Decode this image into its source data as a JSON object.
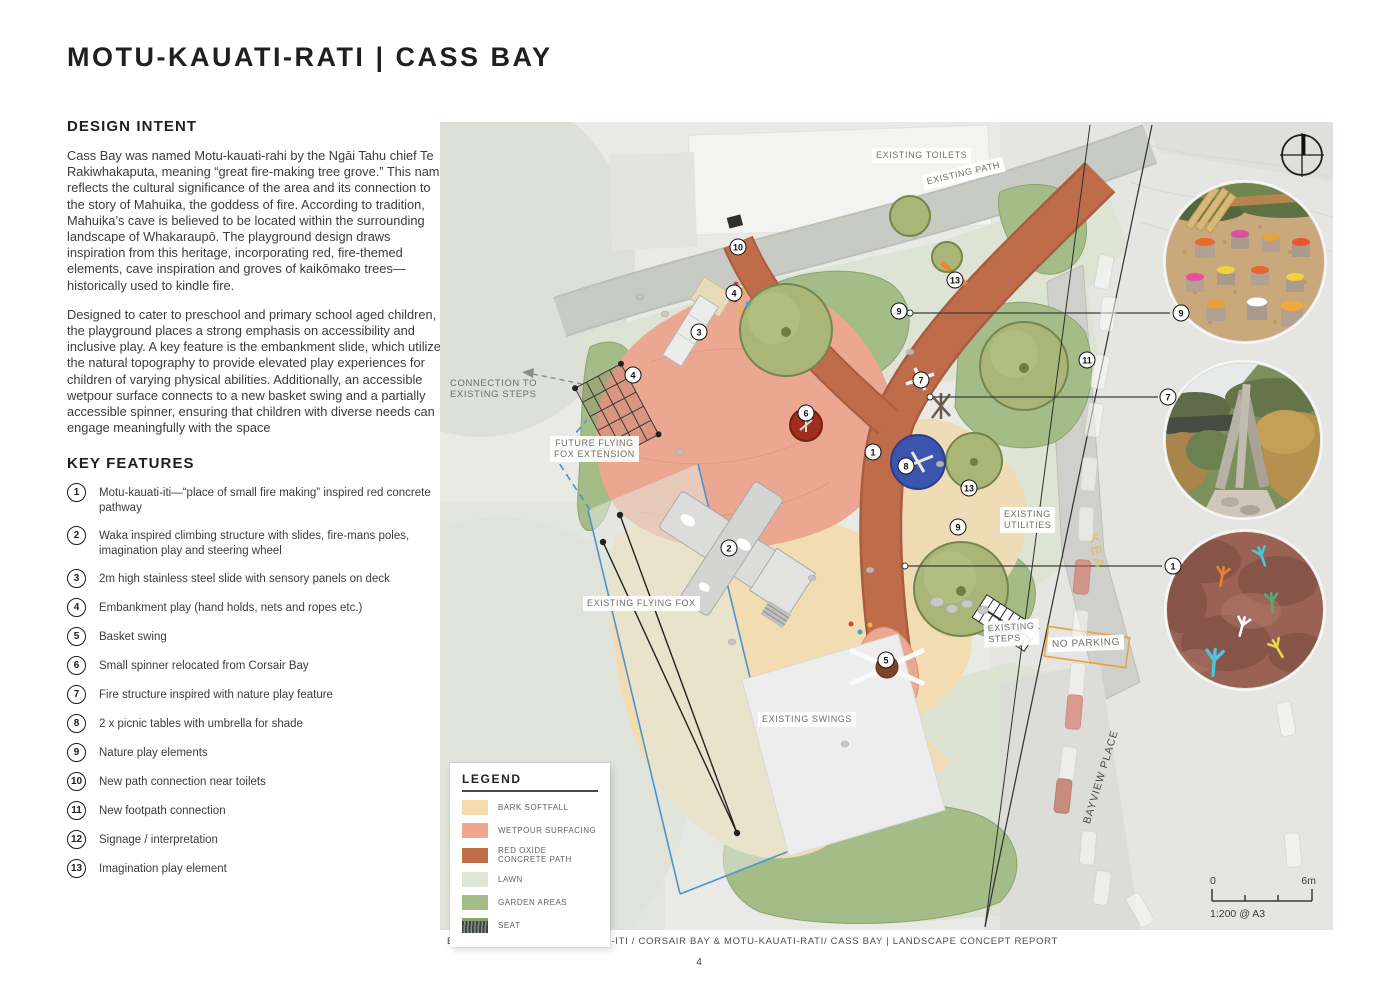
{
  "page": {
    "title": "MOTU-KAUATI-RATI | CASS BAY",
    "footer": "BOFFA MISKELL  |  MOTU-KAUATI-ITI / CORSAIR BAY & MOTU-KAUATI-RATI/ CASS BAY  | LANDSCAPE CONCEPT REPORT",
    "page_number": "4"
  },
  "design_intent": {
    "heading": "DESIGN INTENT",
    "para1": "Cass Bay was named Motu-kauati-rahi by the Ngāi Tahu chief Te Rakiwhakaputa, meaning “great fire-making tree grove.” This name reflects the cultural significance of the area and its connection to the story of Mahuika, the goddess of fire. According to tradition, Mahuika’s cave is believed to be located within the surrounding landscape of Whakaraupō. The playground design draws inspiration from this heritage, incorporating red, fire-themed elements, cave inspiration and groves of kaikōmako trees—historically used to kindle fire.",
    "para2": "Designed to cater to preschool and primary school aged children, the playground places a strong emphasis on accessibility and inclusive play. A key feature is the embankment slide, which utilizes the natural topography to provide elevated play experiences for children of varying physical abilities. Additionally, an accessible wetpour surface connects to a new basket swing and a partially accessible spinner, ensuring that children with diverse needs can engage meaningfully with the space"
  },
  "key_features": {
    "heading": "KEY FEATURES",
    "items": [
      {
        "num": "1",
        "text": "Motu-kauati-iti—“place of small fire making” inspired red concrete pathway"
      },
      {
        "num": "2",
        "text": "Waka inspired climbing structure with slides, fire-mans poles, imagination play and steering wheel"
      },
      {
        "num": "3",
        "text": "2m high stainless steel slide with sensory panels on deck"
      },
      {
        "num": "4",
        "text": "Embankment play (hand holds, nets and ropes etc.)"
      },
      {
        "num": "5",
        "text": "Basket swing"
      },
      {
        "num": "6",
        "text": "Small spinner relocated from Corsair Bay"
      },
      {
        "num": "7",
        "text": "Fire structure inspired with nature play feature"
      },
      {
        "num": "8",
        "text": "2 x picnic tables with umbrella for shade"
      },
      {
        "num": "9",
        "text": "Nature play elements"
      },
      {
        "num": "10",
        "text": "New path connection near toilets"
      },
      {
        "num": "11",
        "text": "New footpath connection"
      },
      {
        "num": "12",
        "text": "Signage / interpretation"
      },
      {
        "num": "13",
        "text": "Imagination play element"
      }
    ]
  },
  "plan": {
    "labels": {
      "toilets": "EXISTING TOILETS",
      "path": "EXISTING PATH",
      "connection": "CONNECTION TO\nEXISTING STEPS",
      "future_fox": "FUTURE FLYING\nFOX EXTENSION",
      "flying_fox": "EXISTING FLYING FOX",
      "swings": "EXISTING SWINGS",
      "utilities": "EXISTING\nUTILITIES",
      "steps": "EXISTING\nSTEPS",
      "no_parking": "NO PARKING",
      "street": "BAYVIEW PLACE"
    },
    "markers": [
      "10",
      "13",
      "9",
      "4",
      "3",
      "4",
      "7",
      "11",
      "6",
      "1",
      "8",
      "13",
      "9",
      "2",
      "5",
      "9",
      "7",
      "1"
    ],
    "scale": {
      "start": "0",
      "end": "6m",
      "ratio": "1:200 @ A3"
    },
    "legend": {
      "title": "LEGEND",
      "items": [
        {
          "label": "BARK SOFTFALL",
          "color": "#f4dcae"
        },
        {
          "label": "WETPOUR SURFACING",
          "color": "#efa68f"
        },
        {
          "label": "RED OXIDE CONCRETE PATH",
          "color": "#bf6c4a"
        },
        {
          "label": "LAWN",
          "color": "#dfe5d3"
        },
        {
          "label": "GARDEN AREAS",
          "color": "#a3bc88"
        },
        {
          "label": "SEAT",
          "color": "#6b6e67"
        }
      ]
    }
  }
}
